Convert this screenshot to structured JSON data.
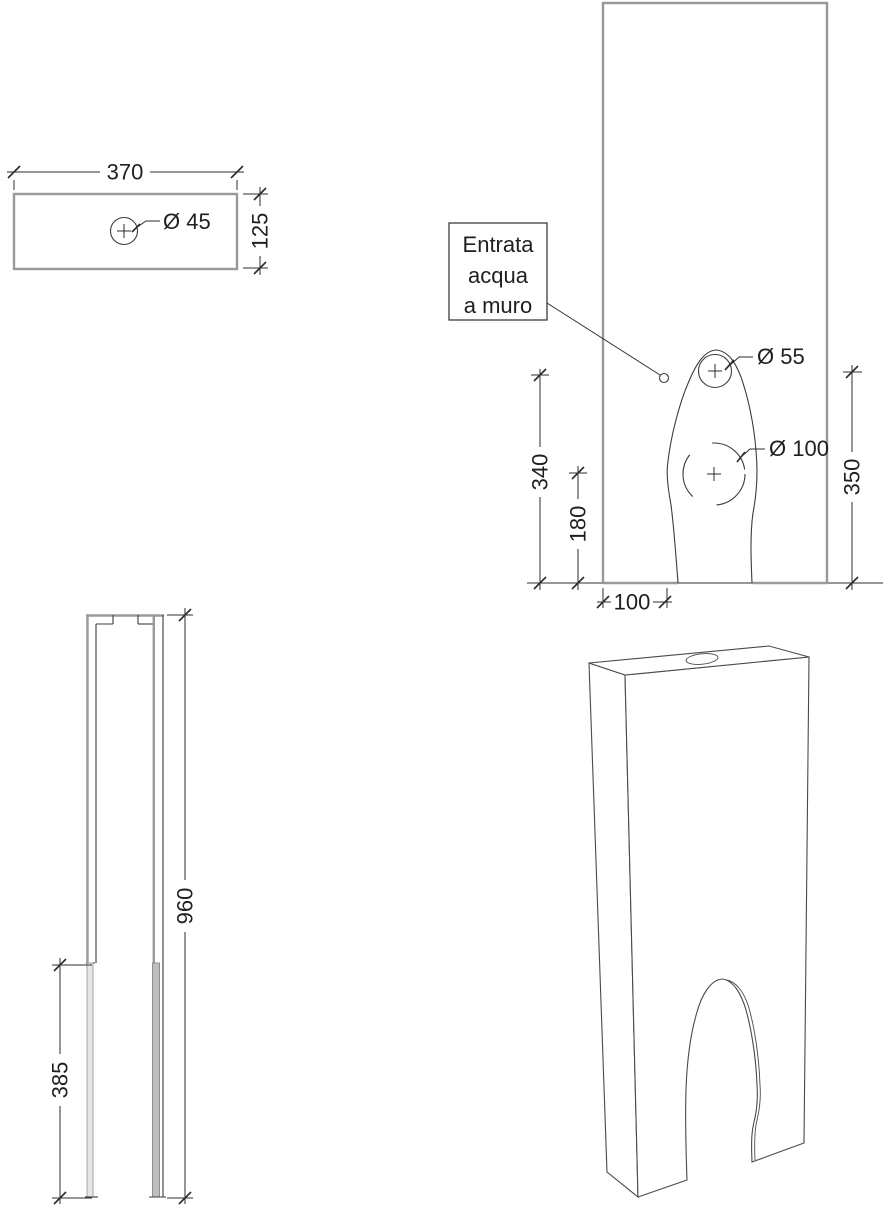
{
  "colors": {
    "line": "#3d3d3d",
    "view_outline": "#9a9a9a",
    "text": "#1f1f1f"
  },
  "views": {
    "top_view": {
      "name": "top view",
      "dims": {
        "width": "370",
        "depth": "125",
        "hole_diameter": "Ø 45"
      }
    },
    "front_view": {
      "name": "front view",
      "note": {
        "line1": "Entrata",
        "line2": "acqua",
        "line3": "a muro"
      },
      "dims": {
        "hole_top": "Ø 55",
        "hole_bottom": "Ø 100",
        "height_hole_top": "340",
        "height_hole_bottom": "180",
        "height_right": "350",
        "bottom_offset": "100"
      }
    },
    "side_view": {
      "name": "side view",
      "dims": {
        "height": "960",
        "cutout_height": "385"
      }
    },
    "iso_view": {
      "name": "isometric view"
    }
  }
}
